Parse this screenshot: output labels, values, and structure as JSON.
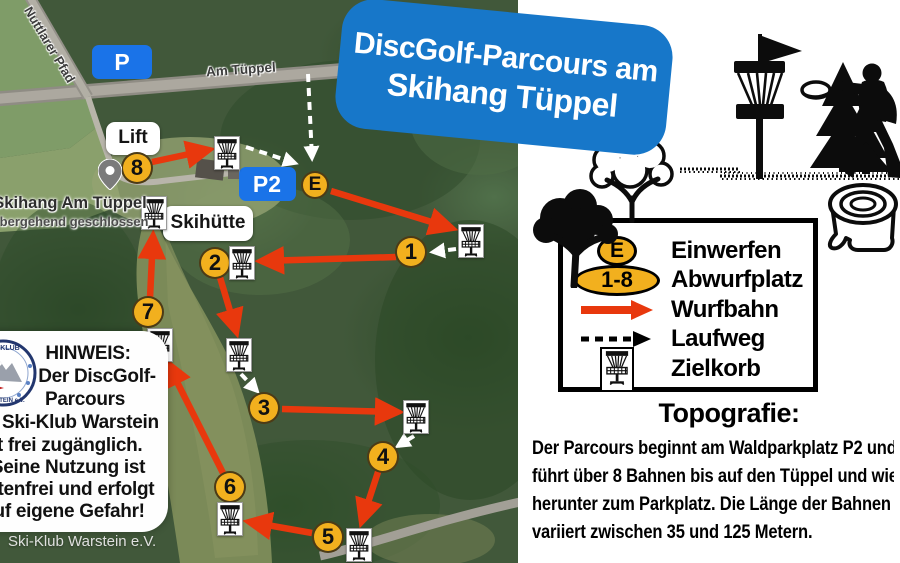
{
  "title": {
    "line1": "DiscGolf-Parcours am",
    "line2": "Skihang Tüppel"
  },
  "map": {
    "road_labels": [
      {
        "text": "Nuttlarer Pfad"
      },
      {
        "text": "Am Tüppel"
      }
    ],
    "parking_badges": [
      {
        "label": "P",
        "x": 122,
        "y": 62,
        "w": 60,
        "h": 34
      },
      {
        "label": "P2",
        "x": 267,
        "y": 184,
        "w": 57,
        "h": 34
      }
    ],
    "place_labels": [
      {
        "text": "Lift",
        "x": 133,
        "y": 138,
        "w": 54,
        "h": 33
      },
      {
        "text": "Skihütte",
        "x": 208,
        "y": 223,
        "w": 90,
        "h": 35
      }
    ],
    "poi": {
      "name": "Skihang Am Tüppel",
      "status": "vorübergehend geschlossen"
    },
    "einwerfen": {
      "label": "E",
      "x": 315,
      "y": 185
    },
    "tees": [
      {
        "label": "1",
        "x": 411,
        "y": 252
      },
      {
        "label": "2",
        "x": 215,
        "y": 263
      },
      {
        "label": "3",
        "x": 264,
        "y": 408
      },
      {
        "label": "4",
        "x": 383,
        "y": 457
      },
      {
        "label": "5",
        "x": 328,
        "y": 537
      },
      {
        "label": "6",
        "x": 230,
        "y": 487
      },
      {
        "label": "7",
        "x": 148,
        "y": 312
      },
      {
        "label": "8",
        "x": 137,
        "y": 168
      }
    ],
    "baskets": [
      {
        "x": 214,
        "y": 136
      },
      {
        "x": 141,
        "y": 196
      },
      {
        "x": 229,
        "y": 246
      },
      {
        "x": 458,
        "y": 224
      },
      {
        "x": 226,
        "y": 338
      },
      {
        "x": 403,
        "y": 400
      },
      {
        "x": 346,
        "y": 528
      },
      {
        "x": 217,
        "y": 502
      },
      {
        "x": 147,
        "y": 328
      }
    ],
    "throw_paths": [
      {
        "x1": 331,
        "y1": 191,
        "x2": 451,
        "y2": 228
      },
      {
        "x1": 396,
        "y1": 257,
        "x2": 262,
        "y2": 261
      },
      {
        "x1": 219,
        "y1": 274,
        "x2": 236,
        "y2": 331
      },
      {
        "x1": 282,
        "y1": 409,
        "x2": 397,
        "y2": 412
      },
      {
        "x1": 379,
        "y1": 469,
        "x2": 362,
        "y2": 521
      },
      {
        "x1": 312,
        "y1": 533,
        "x2": 250,
        "y2": 522
      },
      {
        "x1": 223,
        "y1": 473,
        "x2": 168,
        "y2": 364
      },
      {
        "x1": 150,
        "y1": 298,
        "x2": 153,
        "y2": 237
      },
      {
        "x1": 152,
        "y1": 162,
        "x2": 208,
        "y2": 150
      }
    ],
    "walk_paths": [
      {
        "x1": 308,
        "y1": 74,
        "x2": 312,
        "y2": 158
      },
      {
        "x1": 246,
        "y1": 147,
        "x2": 295,
        "y2": 163
      },
      {
        "x1": 456,
        "y1": 249,
        "x2": 433,
        "y2": 252
      },
      {
        "x1": 241,
        "y1": 374,
        "x2": 257,
        "y2": 391
      },
      {
        "x1": 414,
        "y1": 436,
        "x2": 398,
        "y2": 446
      }
    ]
  },
  "legend": {
    "items": [
      {
        "symbol": "E",
        "label": "Einwerfen"
      },
      {
        "symbol": "1-8",
        "label": "Abwurfplatz"
      },
      {
        "label": "Wurfbahn"
      },
      {
        "label": "Laufweg"
      },
      {
        "label": "Zielkorb"
      }
    ]
  },
  "topografie": {
    "heading": "Topografie:",
    "lines": [
      "Der Parcours beginnt am Waldparkplatz P2 und",
      "führt über 8 Bahnen bis auf den Tüppel und wieder",
      "herunter zum Parkplatz. Die Länge der Bahnen",
      "variiert zwischen 35 und 125 Metern."
    ]
  },
  "hinweis": {
    "lines": [
      "HINWEIS:",
      "Der DiscGolf-",
      "Parcours",
      "des Ski-Klub Warstein",
      "ist frei zugänglich.",
      "Seine Nutzung ist",
      "kostenfrei und erfolgt",
      "auf eigene Gefahr!"
    ]
  },
  "credit": "Ski-Klub Warstein e.V.",
  "colors": {
    "banner_blue": "#1777c9",
    "parking_blue": "#1a73e8",
    "badge_yellow": "#f2b01e",
    "path_red": "#e8380d"
  }
}
